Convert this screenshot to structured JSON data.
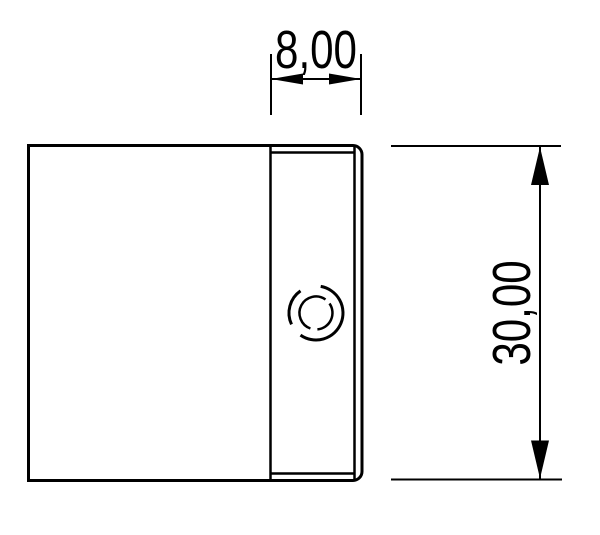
{
  "drawing": {
    "background_color": "#ffffff",
    "line_color": "#000000",
    "dimensions": {
      "width": {
        "label": "8,00",
        "value": 8.0
      },
      "height": {
        "label": "30,00",
        "value": 30.0
      }
    },
    "features": {
      "part": "profile-cross-section",
      "hole": "threaded-hole"
    }
  }
}
